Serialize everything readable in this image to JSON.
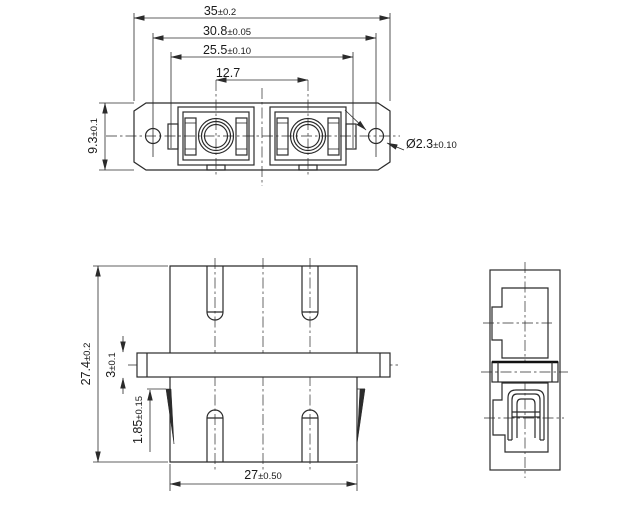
{
  "colors": {
    "line": "#2b2b2b",
    "background": "#ffffff"
  },
  "dimensions": {
    "overall_width": {
      "value": "35",
      "tol": "±0.2"
    },
    "mounting_hole_spacing": {
      "value": "30.8",
      "tol": "±0.05"
    },
    "latch_spacing": {
      "value": "25.5",
      "tol": "±0.10"
    },
    "port_pitch": {
      "value": "12.7",
      "tol": ""
    },
    "front_height": {
      "value": "9.3",
      "tol": "±0.1"
    },
    "mounting_hole_diameter": {
      "value": "Ø2.3",
      "tol": "±0.10"
    },
    "overall_depth": {
      "value": "27.4",
      "tol": "±0.2"
    },
    "flange_thickness": {
      "value": "3",
      "tol": "±0.1"
    },
    "clip_offset": {
      "value": "1.85",
      "tol": "±0.15"
    },
    "body_depth": {
      "value": "27",
      "tol": "±0.50"
    }
  }
}
